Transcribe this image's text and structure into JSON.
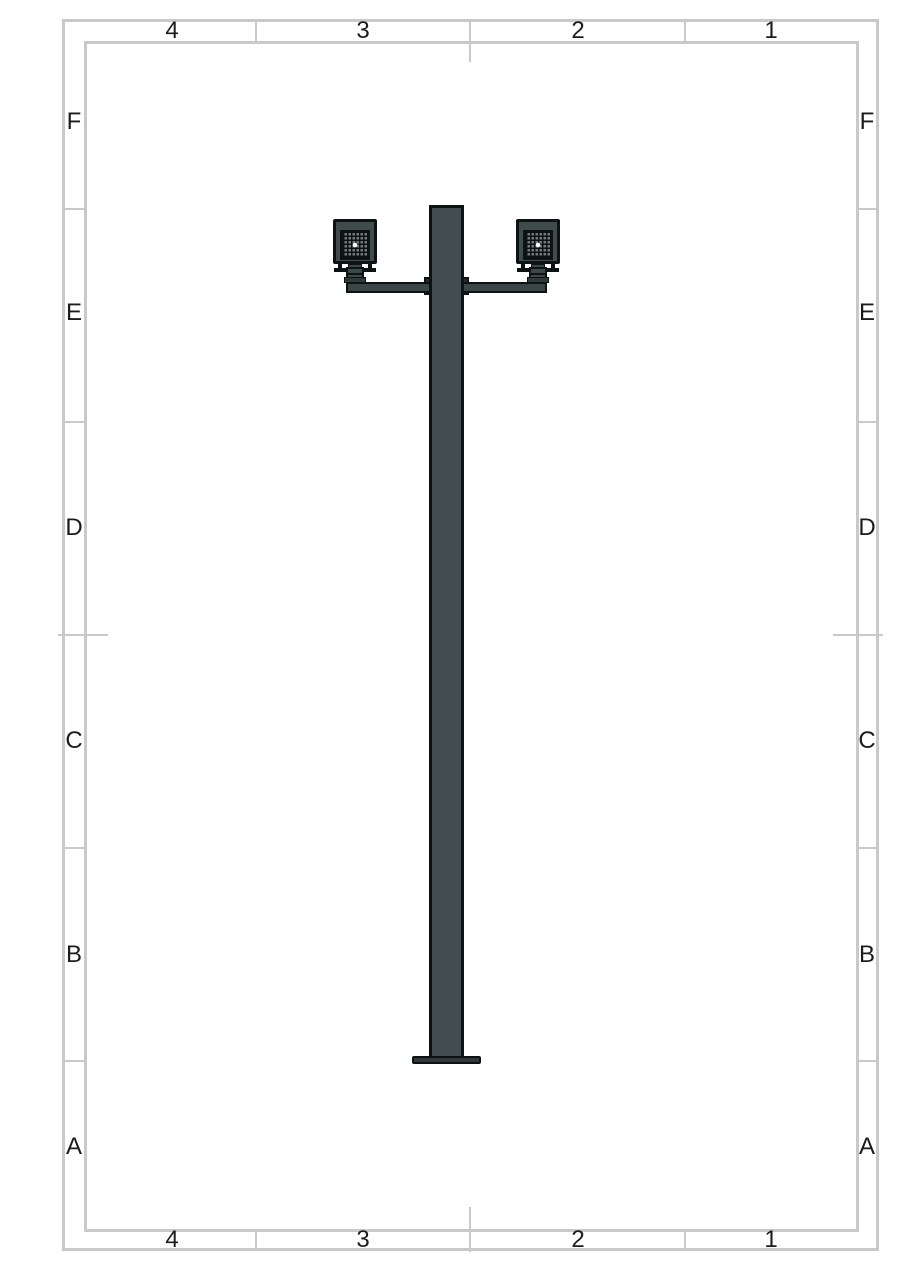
{
  "zones": {
    "columns": [
      "4",
      "3",
      "2",
      "1"
    ],
    "rows": [
      "F",
      "E",
      "D",
      "C",
      "B",
      "A"
    ]
  },
  "colors": {
    "border": "#c8caca",
    "label": "#1c1c1c",
    "outline": "#0d1212",
    "pole": "#424d4f",
    "arm": "#3a4545",
    "bracket": "#242c2c",
    "housing": "#404b4b",
    "led_panel": "#6f7a7a",
    "led_grid": "#0e1212",
    "led_center": "#ffffff",
    "knuckle": "#3d4848",
    "base": "#313a3a"
  }
}
